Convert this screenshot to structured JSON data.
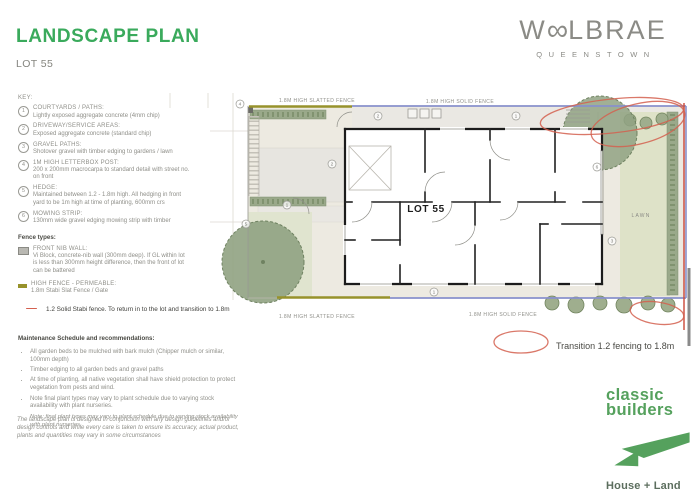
{
  "header": {
    "title": "LANDSCAPE PLAN",
    "subtitle": "LOT 55"
  },
  "brand": {
    "mark_left": "W",
    "mark_oo": "∞",
    "mark_right": "LBRAE",
    "location": "QUEENSTOWN"
  },
  "key": {
    "heading": "KEY:",
    "items": [
      {
        "n": "1",
        "title": "COURTYARDS / PATHS:",
        "desc": "Lightly exposed aggregate concrete (4mm chip)"
      },
      {
        "n": "2",
        "title": "DRIVEWAY/SERVICE AREAS:",
        "desc": "Exposed aggregate concrete (standard chip)"
      },
      {
        "n": "3",
        "title": "GRAVEL PATHS:",
        "desc": "Shotover gravel with timber edging to gardens / lawn"
      },
      {
        "n": "4",
        "title": "1M HIGH LETTERBOX POST:",
        "desc": "200 x 200mm macrocarpa to standard detail with street no. on front"
      },
      {
        "n": "5",
        "title": "HEDGE:",
        "desc": "Maintained between 1.2 - 1.8m high. All hedging in front yard to be 1m high at time of planting, 600mm crs"
      },
      {
        "n": "6",
        "title": "MOWING STRIP:",
        "desc": "130mm wide gravel edging mowing strip with timber"
      }
    ]
  },
  "fence_types": {
    "heading": "Fence types:",
    "items": [
      {
        "title": "FRONT NIB WALL:",
        "desc": "Vi Block, concrete-nib wall (300mm deep). If GL within lot is less than 300mm height difference, then the front of lot can be battered"
      },
      {
        "title": "HIGH FENCE - PERMEABLE:",
        "desc": "1.8m Stabi Slat Fence / Gate"
      }
    ]
  },
  "notes": {
    "stabi": "1.2 Solid Stabi fence. To return in to the lot and transition to 1.8m",
    "disclaimer": "The landscape plan is designed in conjunction with any design guidelines and/or design controls and while every care is taken to ensure its accuracy, actual product, plants and quantities may vary in some circumstances"
  },
  "maintenance": {
    "heading": "Maintenance Schedule and recommendations:",
    "bullets": [
      "All garden beds to be mulched with bark mulch (Chipper mulch or similar, 100mm depth)",
      "Timber edging to all garden beds and gravel paths",
      "At time of planting, all native vegetation shall have shield protection to protect vegetation from pests and wind.",
      "Note final plant types may vary to plant schedule due to varying stock availability with plant nurseries."
    ],
    "note": "Note: final plant types may vary to plant schedule due to varying stock availability with plant nurseries."
  },
  "plan": {
    "lot_label": "LOT 55",
    "lawn_label": "LAWN",
    "fence_labels": {
      "top_slatted": "1.8M HIGH SLATTED FENCE",
      "top_solid": "1.8M HIGH SOLID FENCE",
      "bottom_slatted": "1.8M HIGH SLATTED FENCE",
      "bottom_solid": "1.8M HIGH SOLID FENCE"
    },
    "annotation": "Transition 1.2 fencing to 1.8m",
    "callouts": [
      {
        "n": "4"
      },
      {
        "n": "2"
      },
      {
        "n": "1"
      },
      {
        "n": "2"
      },
      {
        "n": "1"
      },
      {
        "n": "5"
      },
      {
        "n": "6"
      },
      {
        "n": "3"
      },
      {
        "n": "1"
      }
    ]
  },
  "builder": {
    "line1": "classic",
    "line2": "builders",
    "tagline": "House + Land"
  },
  "colors": {
    "title_green": "#3aaa5c",
    "builder_green": "#55a15d",
    "fence_solid_blue": "#8891cc",
    "fence_slatted_olive": "#97922b",
    "annotation_red": "#d4604f",
    "lawn_green": "#dee2c8",
    "hedge_green": "#9fae8e"
  }
}
